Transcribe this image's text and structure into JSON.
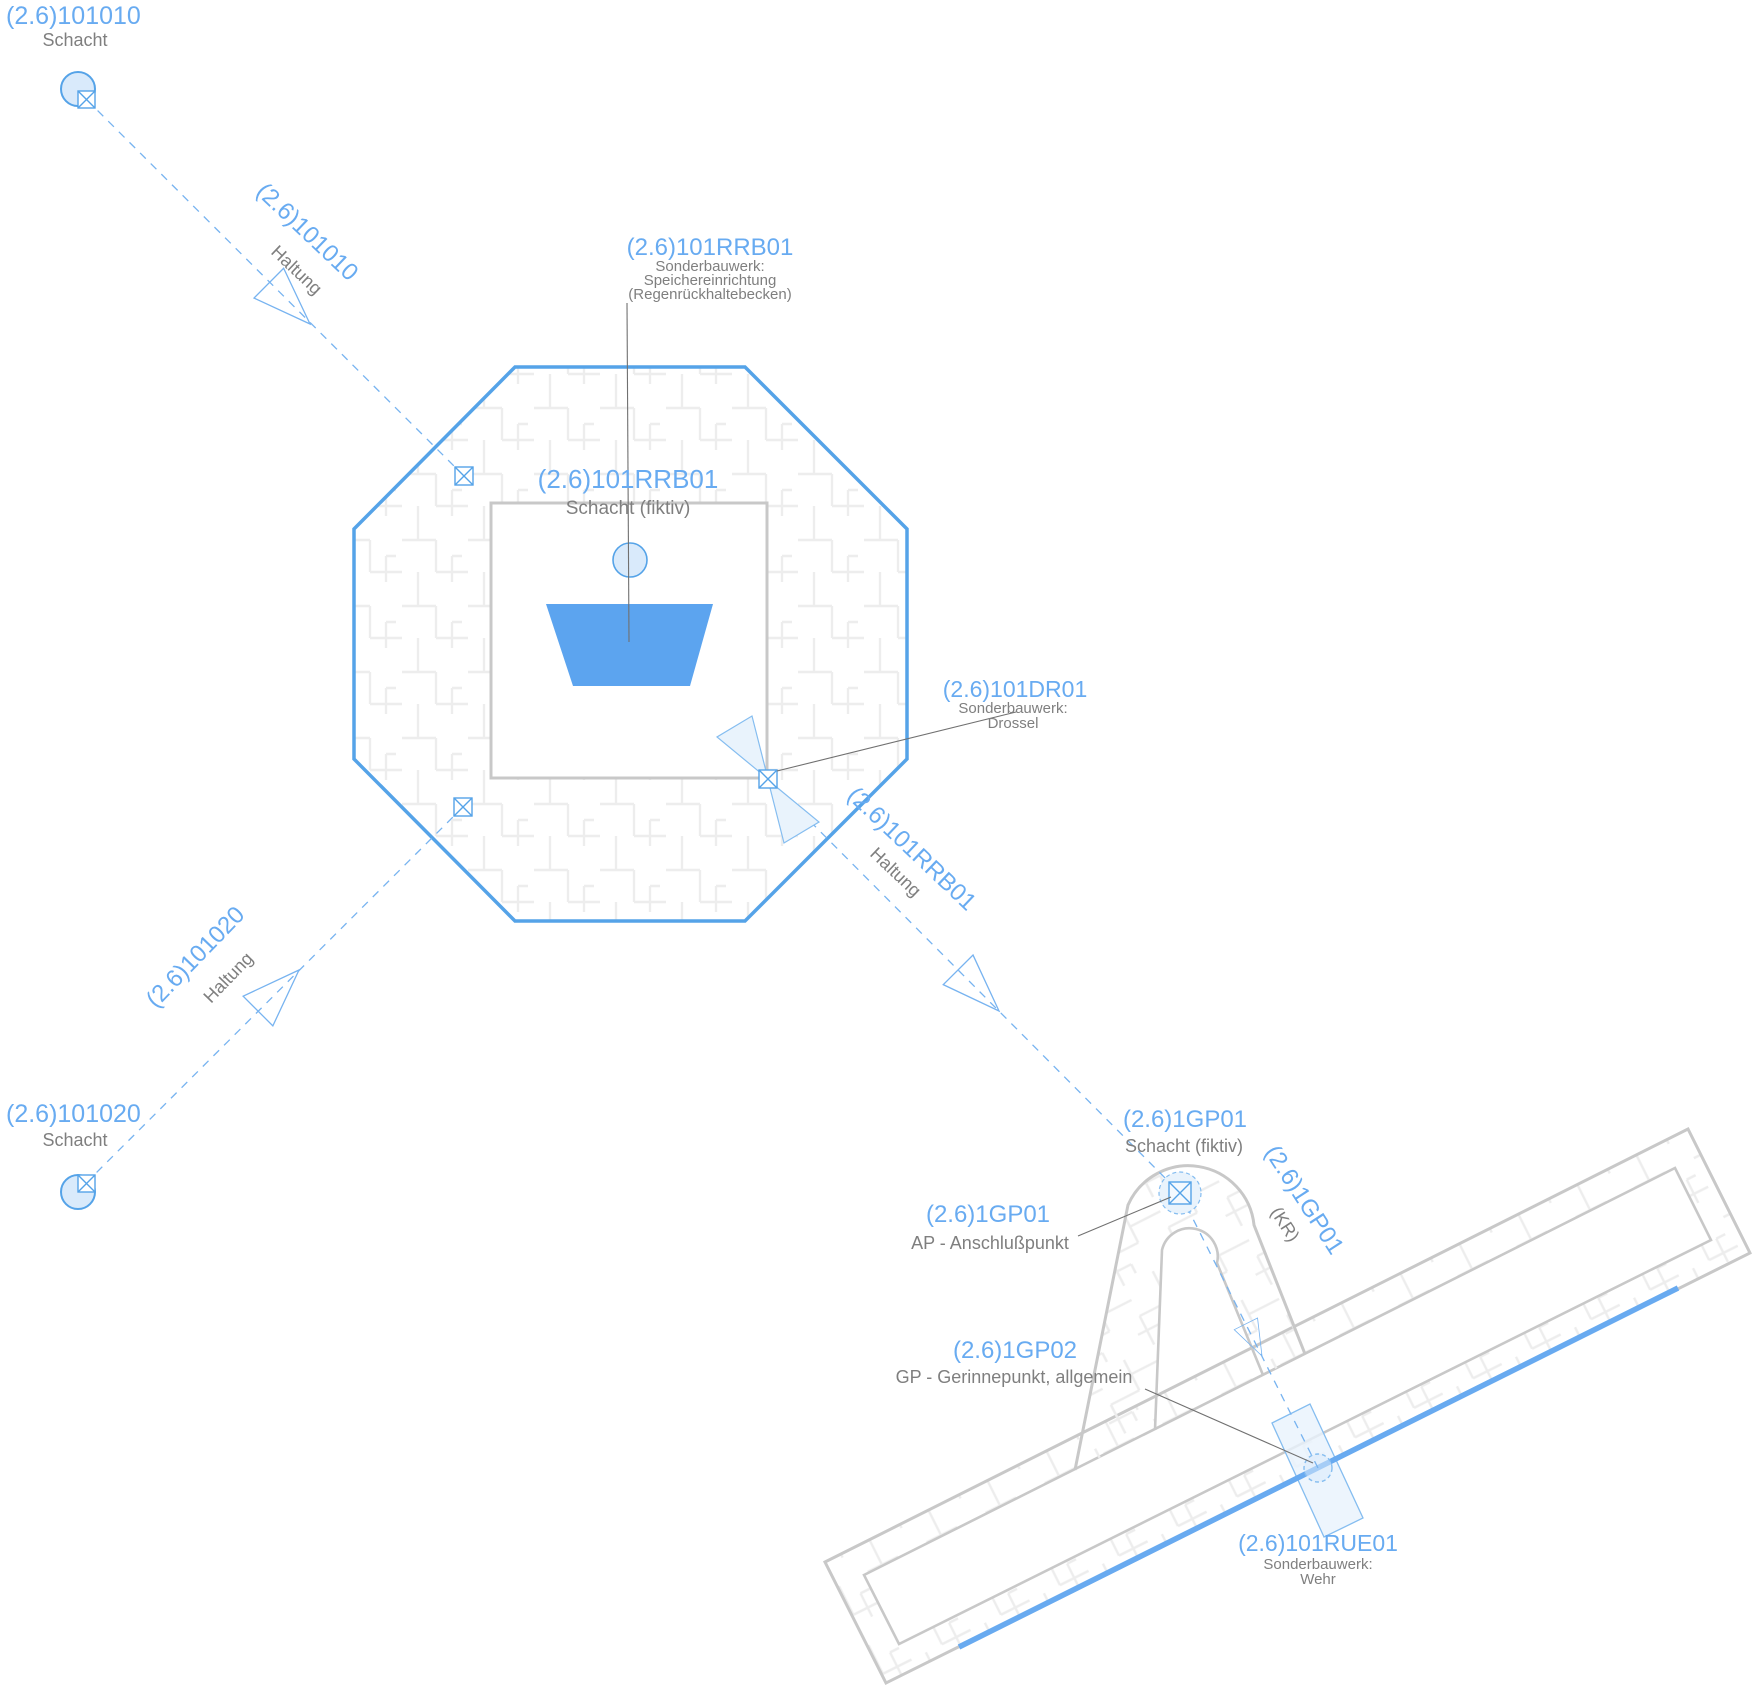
{
  "canvas": {
    "width": 1752,
    "height": 1687,
    "background": "#ffffff"
  },
  "colors": {
    "node_label_blue": "#68abf1",
    "type_label_gray": "#7f7f7f",
    "network_blue": "#55a3e8",
    "dashed_edge_blue": "#77b3f0",
    "pale_fill_blue": "#d9eafb",
    "structure_fill_blue": "#e9f3fc",
    "wall_gray": "#c8c8c8",
    "hatch_gray": "#ededed",
    "basin_trapezoid_blue": "#5ca4ef",
    "gerinne_line_blue": "#68aaf0",
    "leader_gray": "#707070"
  },
  "labels": {
    "schacht_101010": {
      "id": "(2.6)101010",
      "type": "Schacht"
    },
    "haltung_101010": {
      "id": "(2.6)101010",
      "type": "Haltung"
    },
    "rrb_structure": {
      "id": "(2.6)101RRB01",
      "line1": "Sonderbauwerk:",
      "line2": "Speichereinrichtung",
      "line3": "(Regenrückhaltebecken)"
    },
    "rrb_schacht": {
      "id": "(2.6)101RRB01",
      "type": "Schacht (fiktiv)"
    },
    "drossel": {
      "id": "(2.6)101DR01",
      "line1": "Sonderbauwerk:",
      "line2": "Drossel"
    },
    "schacht_101020": {
      "id": "(2.6)101020",
      "type": "Schacht"
    },
    "haltung_101020": {
      "id": "(2.6)101020",
      "type": "Haltung"
    },
    "haltung_rrb": {
      "id": "(2.6)101RRB01",
      "type": "Haltung"
    },
    "gp01_schacht": {
      "id": "(2.6)1GP01",
      "type": "Schacht (fiktiv)"
    },
    "gp01_ap": {
      "id": "(2.6)1GP01",
      "type": "AP - Anschlußpunkt"
    },
    "gp01_kr": {
      "id": "(2.6)1GP01",
      "type": "(KR)"
    },
    "gp02": {
      "id": "(2.6)1GP02",
      "type": "GP - Gerinnepunkt, allgemein"
    },
    "rue01": {
      "id": "(2.6)101RUE01",
      "line1": "Sonderbauwerk:",
      "line2": "Wehr"
    }
  }
}
